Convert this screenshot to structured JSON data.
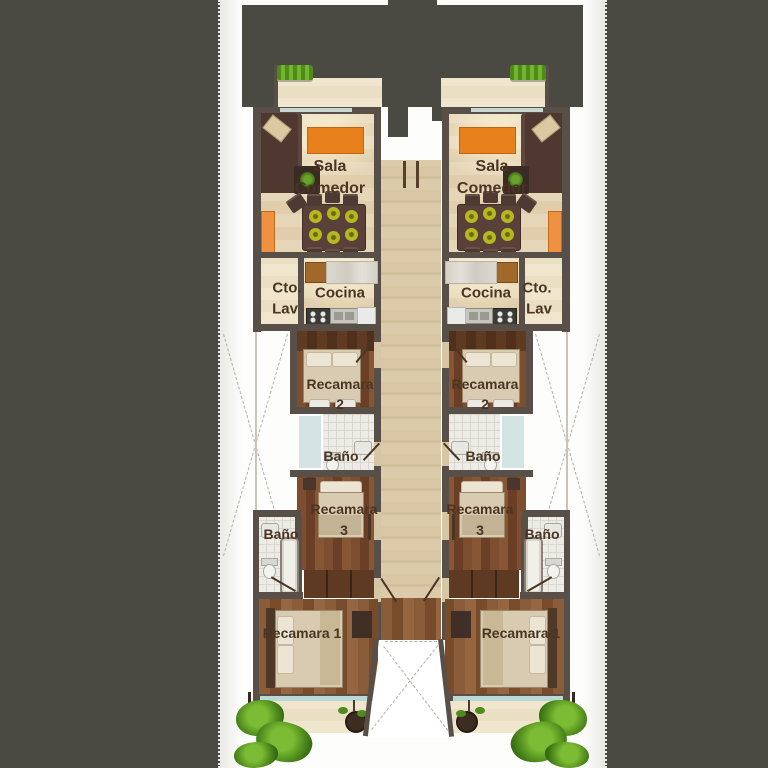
{
  "title": "Planta arquitectonica - dos departamentos en espejo",
  "colors": {
    "site_dark": "#4a4a43",
    "wall": "#584f49",
    "floor_beige": "#e4d4b5",
    "floor_wood": "#7a4c2e",
    "floor_wood_light": "#8a5a38",
    "floor_tile": "#edebe5",
    "corridor_stone": "#d7c6a5",
    "accent_orange": "#e8811c",
    "accent_orange_light": "#ef9140",
    "plant_green": "#5a9a22",
    "glass_teal": "#bcd8d4",
    "label_text": "#4a3524"
  },
  "units": [
    {
      "side": "left",
      "labels": {
        "sala_1": "Sala",
        "sala_2": "Comedor",
        "cto_1": "Cto.",
        "cto_2": "Lav",
        "cocina": "Cocina",
        "rec2_1": "Recamara",
        "rec2_2": "2",
        "bano_in": "Baño",
        "rec3_1": "Recamara",
        "rec3_2": "3",
        "bano_out": "Baño",
        "rec1": "Recamara 1"
      }
    },
    {
      "side": "right",
      "labels": {
        "sala_1": "Sala",
        "sala_2": "Comedor",
        "cto_1": "Cto.",
        "cto_2": "Lav",
        "cocina": "Cocina",
        "rec2_1": "Recamara",
        "rec2_2": "2",
        "bano_in": "Baño",
        "rec3_1": "Recamara",
        "rec3_2": "3",
        "bano_out": "Baño",
        "rec1": "Recamara 1"
      }
    }
  ]
}
